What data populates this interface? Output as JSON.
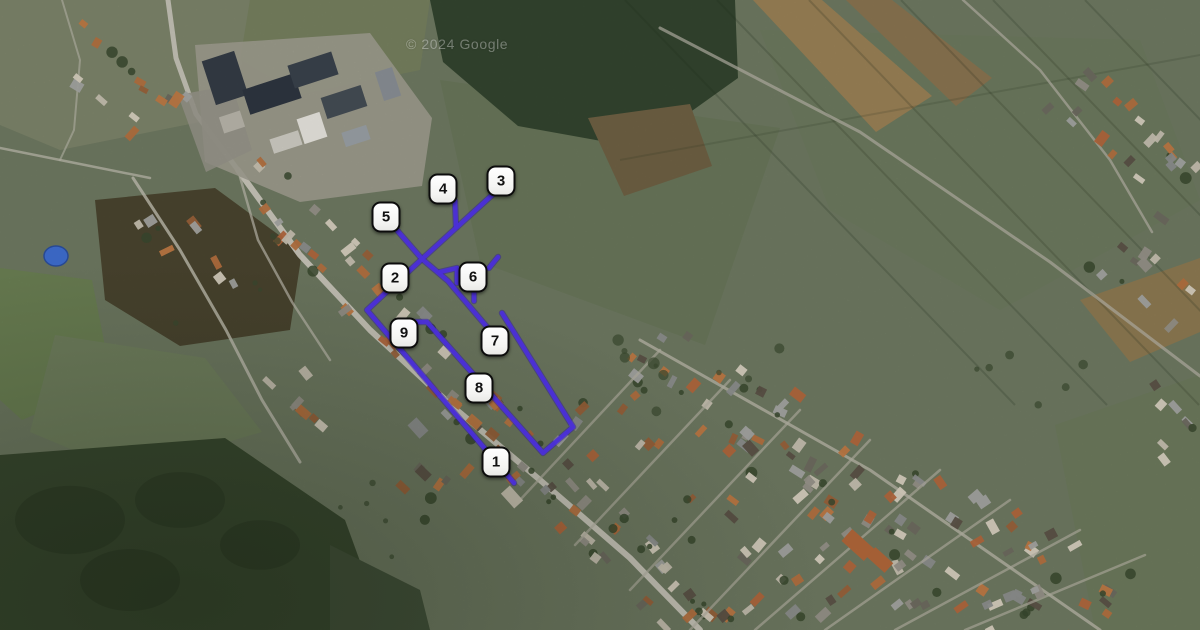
{
  "map": {
    "type": "satellite",
    "attribution": "© 2024 Google",
    "markers": [
      {
        "label": "1",
        "x": 496,
        "y": 462
      },
      {
        "label": "2",
        "x": 395,
        "y": 278
      },
      {
        "label": "3",
        "x": 501,
        "y": 181
      },
      {
        "label": "4",
        "x": 443,
        "y": 189
      },
      {
        "label": "5",
        "x": 386,
        "y": 217
      },
      {
        "label": "6",
        "x": 473,
        "y": 277
      },
      {
        "label": "7",
        "x": 495,
        "y": 341
      },
      {
        "label": "8",
        "x": 479,
        "y": 388
      },
      {
        "label": "9",
        "x": 404,
        "y": 333
      }
    ],
    "route": {
      "color": "#4b2fd8",
      "outline_color": "#2c1a9e",
      "width": 4.4,
      "segments": [
        {
          "name": "route-5-to-7",
          "points": [
            [
              389,
              221
            ],
            [
              422,
              259
            ],
            [
              448,
              281
            ],
            [
              487,
              327
            ]
          ]
        },
        {
          "name": "route-3-to-1",
          "points": [
            [
              501,
              187
            ],
            [
              422,
              259
            ],
            [
              367,
              310
            ],
            [
              514,
              483
            ]
          ]
        },
        {
          "name": "spur-6-west",
          "points": [
            [
              440,
              272
            ],
            [
              457,
              268
            ],
            [
              457,
              283
            ]
          ]
        },
        {
          "name": "spur-6-south",
          "points": [
            [
              474,
              284
            ],
            [
              474,
              301
            ]
          ]
        },
        {
          "name": "spur-6-east",
          "points": [
            [
              489,
              268
            ],
            [
              498,
              257
            ]
          ]
        },
        {
          "name": "spur-4",
          "points": [
            [
              455,
              201
            ],
            [
              456,
              227
            ]
          ]
        },
        {
          "name": "route-9-8-7-loop",
          "points": [
            [
              402,
              322
            ],
            [
              427,
              322
            ],
            [
              543,
              453
            ],
            [
              573,
              427
            ],
            [
              502,
              313
            ]
          ]
        }
      ]
    }
  }
}
